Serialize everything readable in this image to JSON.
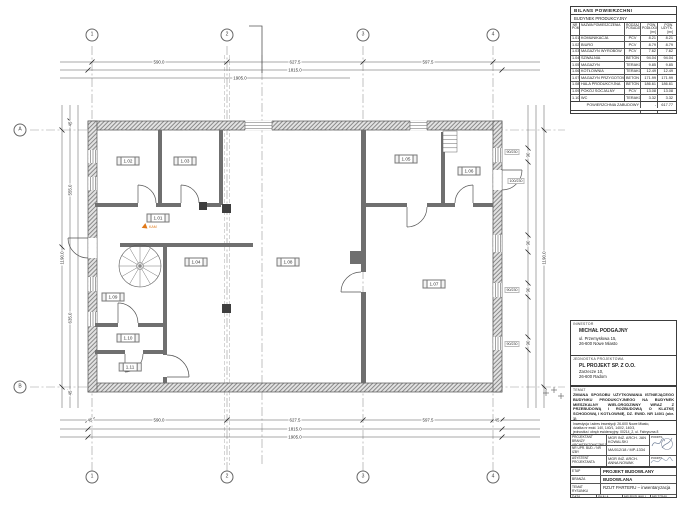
{
  "axes": {
    "cols": [
      "1",
      "2",
      "3",
      "4"
    ],
    "rows": [
      "A",
      "B"
    ]
  },
  "rooms": [
    "1.01",
    "1.02",
    "1.03",
    "1.04",
    "1.05",
    "1.06",
    "1.07",
    "1.08",
    "1.09",
    "1.10",
    "1.11"
  ],
  "dims": {
    "top": [
      "590.0",
      "627.5",
      "597.5",
      "1815.0",
      "1905.0"
    ],
    "bottom": [
      "45",
      "590.0",
      "627.5",
      "597.5",
      "45",
      "1815.0",
      "1905.0"
    ],
    "left": [
      "45",
      "555.0",
      "635.0",
      "1190.0",
      "45"
    ],
    "right": [
      "90",
      "90",
      "90",
      "90",
      "1190.0"
    ]
  },
  "window_labels": [
    "90/230",
    "100/230",
    "90/230",
    "90/230"
  ],
  "markers": {
    "photo_label": "KAM"
  },
  "bilans": {
    "title": "BILANS POWIERZCHNI",
    "subtitle": "BUDYNEK PRODUKCYJNY",
    "col_nr": "NR POM.",
    "col_name": "NAZWA POMIESZCZENIA",
    "col_floor": "RODZAJ POSADZKI",
    "col_area1": "POW. PODŁOGI [m²]",
    "col_area2": "POW. UŻYTK. [m²]",
    "rows": [
      {
        "nr": "1.01",
        "name": "KOMUNIKACJA",
        "floor": "PCV",
        "a1": "8.21",
        "a2": "8.21"
      },
      {
        "nr": "1.02",
        "name": "BIURO",
        "floor": "PCV",
        "a1": "8.79",
        "a2": "8.79"
      },
      {
        "nr": "1.03",
        "name": "MAGAZYN WYROBÓW",
        "floor": "PCV",
        "a1": "7.62",
        "a2": "7.62"
      },
      {
        "nr": "1.04",
        "name": "SZWALNIA",
        "floor": "BETON",
        "a1": "94.04",
        "a2": "94.04"
      },
      {
        "nr": "1.05",
        "name": "MAGAZYN",
        "floor": "TERAKOTA",
        "a1": "9.85",
        "a2": "9.85"
      },
      {
        "nr": "1.06",
        "name": "KOTŁOWNIA",
        "floor": "TERAKOTA",
        "a1": "12.49",
        "a2": "12.49"
      },
      {
        "nr": "1.07",
        "name": "MAGAZYN PRZYGOTOWALNI",
        "floor": "BETON",
        "a1": "171.99",
        "a2": "171.99"
      },
      {
        "nr": "1.08",
        "name": "HALA PRODUKCYJNA",
        "floor": "BETON",
        "a1": "186.61",
        "a2": "186.61"
      },
      {
        "nr": "1.09",
        "name": "POKÓJ SOCJALNY",
        "floor": "PCV",
        "a1": "13.08",
        "a2": "13.08"
      },
      {
        "nr": "1.10",
        "name": "WC",
        "floor": "TERAKOTA",
        "a1": "3.32",
        "a2": "3.32"
      },
      {
        "nr": "1.11",
        "name": "MAGAZYN",
        "floor": "TERAKOTA",
        "a1": "2.85",
        "a2": "2.85"
      }
    ],
    "sum_label": "SUMA POWIERZCHNI",
    "sum1": "518.85",
    "sum2": "518.85",
    "zabudowa_label": "POWIERZCHNIA ZABUDOWY",
    "zabudowa_dash": "-",
    "zabudowa_value": "617.77"
  },
  "titleblock": {
    "inwestor_label": "INWESTOR",
    "inwestor_name": "MICHAŁ PODGAJNY",
    "inwestor_addr1": "ul. Przemysłowa 15,",
    "inwestor_addr2": "26-600 Nowe Miasto",
    "jednostka_label": "JEDNOSTKA PROJEKTOWA",
    "jednostka_name": "PL PROJEKT SP. Z O.O.",
    "jednostka_addr1": "Zarzecze 10,",
    "jednostka_addr2": "26-600 Radom",
    "temat_label": "TEMAT",
    "temat_text": "ZMIANA SPOSOBU UŻYTKOWANIA ISTNIEJĄCEGO BUDYNKU PRODUKCYJNEGO NA BUDYNEK MIESZKALNY WIELORODZINNY WRAZ Z PRZEBUDOWĄ I ROZBUDOWĄ O KLATKĘ SCHODOWĄ I KOTŁOWNIĘ, DZ. EWID. NR 140/1 (obr. 1)",
    "lokalizacja1": "Inwestycja i adres inwestycji: 26-600 Nowe Miasto,",
    "lokalizacja2": "działka nr ewid. 140, 140/1, 140/2, 140/3,",
    "lokalizacja3": "jednostka i obręb ewidencyjny: 00214_2, ul. Fabryczna 8",
    "projektant_label": "PROJEKTANT BRANŻY ARCHITEKTONICZNEJ",
    "projektant_name": "MGR INŻ. ARCH. JAN KOWALSKI",
    "podpis_label": "PODPIS",
    "upr_label": "NR UPR. BUD. / NR IZBY",
    "upr_value": "MA/012/18 / MP-1334",
    "asystent_label": "ASYSTENT PROJEKTANTA",
    "asystent_name": "MGR INŻ. ARCH. ANNA NOWAK",
    "podpis2_label": "PODPIS",
    "etap_label": "ETAP",
    "etap_value": "PROJEKT BUDOWLANY",
    "branza_label": "BRANŻA",
    "branza_value": "BUDOWLANA",
    "rysunek_label": "TEMAT RYSUNKU",
    "rysunek_value": "RZUT PARTERU – inwentaryzacja",
    "data_label": "DATA",
    "data_value": "V 2024",
    "skala_label": "SKALA",
    "skala_value": "1:75",
    "nr_label": "NR RYSUNKU",
    "nr_value": "I-01",
    "tom_label": "NR TOMU",
    "tom_value": ""
  }
}
